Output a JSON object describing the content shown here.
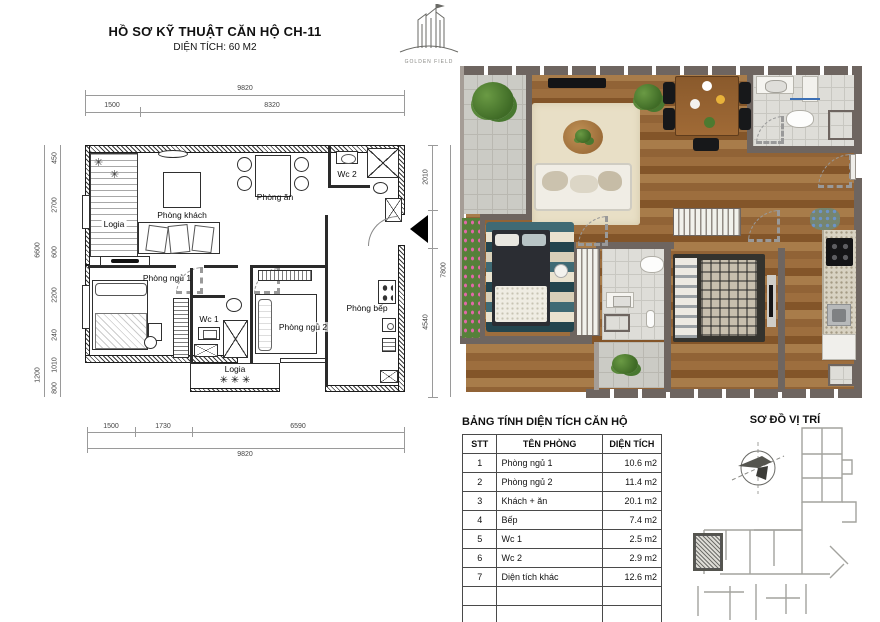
{
  "title_block": {
    "title": "HỒ SƠ KỸ THUẬT CĂN HỘ CH-11",
    "subtitle": "DIỆN TÍCH: 60 M2"
  },
  "logo": {
    "brand": "GOLDEN FIELD"
  },
  "tech_plan": {
    "rooms": {
      "logia_top": "Logia",
      "living": "Phòng khách",
      "dining": "Phòng ăn",
      "wc2": "Wc 2",
      "bedroom1": "Phòng ngủ 1",
      "wc1": "Wc 1",
      "bedroom2": "Phòng ngủ 2",
      "kitchen": "Phòng bếp",
      "logia_bottom": "Logia"
    },
    "dims": {
      "top_total": "9820",
      "top_seg1": "1500",
      "top_seg2": "8320",
      "bottom_seg1": "1500",
      "bottom_seg2": "1730",
      "bottom_seg3": "6590",
      "bottom_total": "9820",
      "left_total": "6600",
      "left_seg1": "450",
      "left_seg2": "2700",
      "left_seg3": "600",
      "left_seg4": "2200",
      "left_seg5": "240",
      "left_seg6": "1010",
      "left_seg7": "1200",
      "left_seg8": "800",
      "right_seg1": "2010",
      "right_seg2": "1250",
      "right_seg3": "4540",
      "right_total": "7800"
    },
    "plant_symbol": "✳ ✳ ✳",
    "plant_symbol_small": "✳"
  },
  "area_table": {
    "title": "BẢNG TÍNH DIỆN TÍCH CĂN HỘ",
    "headers": [
      "STT",
      "TÊN PHÒNG",
      "DIỆN TÍCH"
    ],
    "rows": [
      {
        "stt": "1",
        "name": "Phòng ngủ 1",
        "area": "10.6 m2"
      },
      {
        "stt": "2",
        "name": "Phòng ngủ 2",
        "area": "11.4 m2"
      },
      {
        "stt": "3",
        "name": "Khách + ăn",
        "area": "20.1 m2"
      },
      {
        "stt": "4",
        "name": "Bếp",
        "area": "7.4 m2"
      },
      {
        "stt": "5",
        "name": "Wc 1",
        "area": "2.5 m2"
      },
      {
        "stt": "6",
        "name": "Wc 2",
        "area": "2.9 m2"
      },
      {
        "stt": "7",
        "name": "Diện tích khác",
        "area": "12.6 m2"
      }
    ],
    "total_label": "TỔNG",
    "total_area": "66 m2"
  },
  "location_map": {
    "title": "SƠ ĐỒ VỊ TRÍ"
  },
  "render_colors": {
    "wall": "#6e6560",
    "wood": "#9c6b39",
    "tile": "#cbcbc5",
    "rug": "#e8dfc6",
    "sofa": "#f0ede5",
    "plant_green": "#4c7a30",
    "flower_pink": "#d8589b",
    "appliance_black": "#141416"
  }
}
